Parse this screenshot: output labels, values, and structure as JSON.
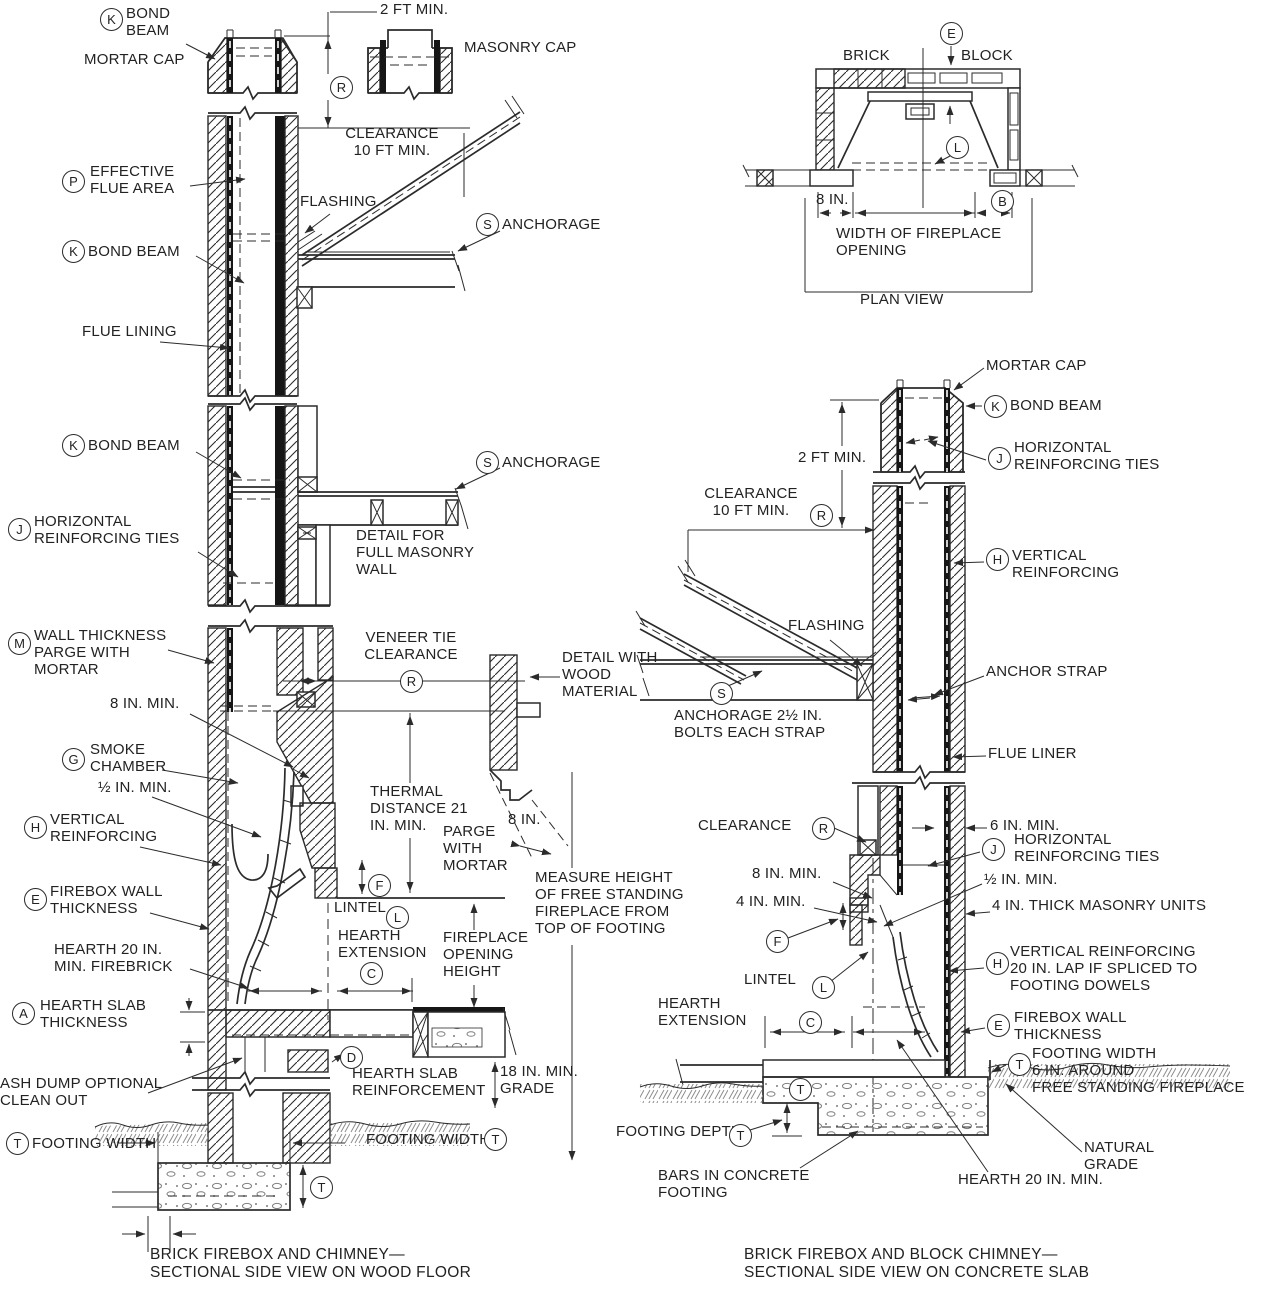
{
  "ink": "#2b2b2b",
  "left": {
    "k1": "K",
    "k1_text": "BOND\nBEAM",
    "mortar_cap": "MORTAR CAP",
    "dim_2ft": "2 FT MIN.",
    "masonry_cap": "MASONRY CAP",
    "r1": "R",
    "clearance1": "CLEARANCE\n10 FT MIN.",
    "p": "P",
    "p_text": "EFFECTIVE\nFLUE AREA",
    "k2": "K",
    "k2_text": "BOND BEAM",
    "flashing": "FLASHING",
    "s1": "S",
    "s1_text": "ANCHORAGE",
    "flue_lining": "FLUE LINING",
    "k3": "K",
    "k3_text": "BOND BEAM",
    "s2": "S",
    "s2_text": "ANCHORAGE",
    "j1": "J",
    "j1_text": "HORIZONTAL\nREINFORCING TIES",
    "masonry_wall_detail": "DETAIL FOR\nFULL MASONRY\nWALL",
    "m": "M",
    "m_text": "WALL THICKNESS\nPARGE WITH\nMORTAR",
    "veneer_tie": "VENEER TIE\nCLEARANCE",
    "r2": "R",
    "dim_8in_min": "8 IN. MIN.",
    "g": "G",
    "g_text": "SMOKE\nCHAMBER",
    "dim_half_in": "½ IN. MIN.",
    "h": "H",
    "h_text": "VERTICAL\nREINFORCING",
    "e": "E",
    "e_text": "FIREBOX WALL\nTHICKNESS",
    "hearth_label": "HEARTH 20 IN.\nMIN. FIREBRICK",
    "a": "A",
    "a_text": "HEARTH SLAB\nTHICKNESS",
    "ash_dump": "ASH DUMP OPTIONAL\nCLEAN OUT",
    "t1": "T",
    "t1_text": "FOOTING WIDTH",
    "t2_text": "FOOTING WIDTH",
    "t2": "T",
    "t3": "T",
    "d": "D",
    "d_text": "HEARTH SLAB\nREINFORCEMENT",
    "grade_18": "18 IN. MIN.\nGRADE",
    "thermal": "THERMAL\nDISTANCE 21\nIN. MIN.",
    "parge": "PARGE\nWITH\nMORTAR",
    "dim_8in2": "8 IN.",
    "wood_detail": "DETAIL WITH\nWOOD\nMATERIAL",
    "f": "F",
    "lintel": "LINTEL",
    "l": "L",
    "hearth_ext": "HEARTH\nEXTENSION",
    "c": "C",
    "opening_height": "FIREPLACE\nOPENING\nHEIGHT",
    "measure_height": "MEASURE HEIGHT\nOF FREE STANDING\nFIREPLACE FROM\nTOP OF FOOTING",
    "caption": "BRICK FIREBOX AND CHIMNEY—\nSECTIONAL SIDE VIEW ON WOOD FLOOR"
  },
  "right": {
    "mortar_cap": "MORTAR CAP",
    "k": "K",
    "k_text": "BOND BEAM",
    "dim_2ft": "2 FT MIN.",
    "j1": "J",
    "j1_text": "HORIZONTAL\nREINFORCING TIES",
    "clearance1": "CLEARANCE\n10 FT MIN.",
    "r1": "R",
    "flashing": "FLASHING",
    "h1": "H",
    "h1_text": "VERTICAL\nREINFORCING",
    "anchor_strap": "ANCHOR STRAP",
    "s": "S",
    "s_text": "ANCHORAGE 2½ IN.\nBOLTS EACH STRAP",
    "flue_liner": "FLUE LINER",
    "clearance2": "CLEARANCE",
    "r2": "R",
    "dim_6in": "6 IN. MIN.",
    "j2": "J",
    "j2_text": "HORIZONTAL\nREINFORCING TIES",
    "dim_half": "½ IN. MIN.",
    "masonry_units": "4 IN. THICK MASONRY UNITS",
    "dim_8in": "8 IN. MIN.",
    "dim_4in": "4 IN. MIN.",
    "f": "F",
    "lintel": "LINTEL",
    "l": "L",
    "h2": "H",
    "h2_text": "VERTICAL REINFORCING\n20 IN. LAP IF SPLICED TO\nFOOTING DOWELS",
    "hearth_ext": "HEARTH\nEXTENSION",
    "c": "C",
    "e": "E",
    "e_text": "FIREBOX WALL\nTHICKNESS",
    "t1": "T",
    "t1_text": "FOOTING WIDTH\n6 IN. AROUND\nFREE STANDING FIREPLACE",
    "t2": "T",
    "footing_depth": "FOOTING DEPTH",
    "t3": "T",
    "bars": "BARS IN CONCRETE\nFOOTING",
    "hearth_20": "HEARTH 20 IN. MIN.",
    "natural_grade": "NATURAL\nGRADE",
    "caption": "BRICK FIREBOX AND BLOCK CHIMNEY—\nSECTIONAL SIDE VIEW ON CONCRETE SLAB"
  },
  "plan": {
    "e": "E",
    "brick": "BRICK",
    "block": "BLOCK",
    "l": "L",
    "b": "B",
    "dim_8in": "8 IN.",
    "width_label": "WIDTH OF FIREPLACE\nOPENING",
    "title": "PLAN VIEW"
  }
}
